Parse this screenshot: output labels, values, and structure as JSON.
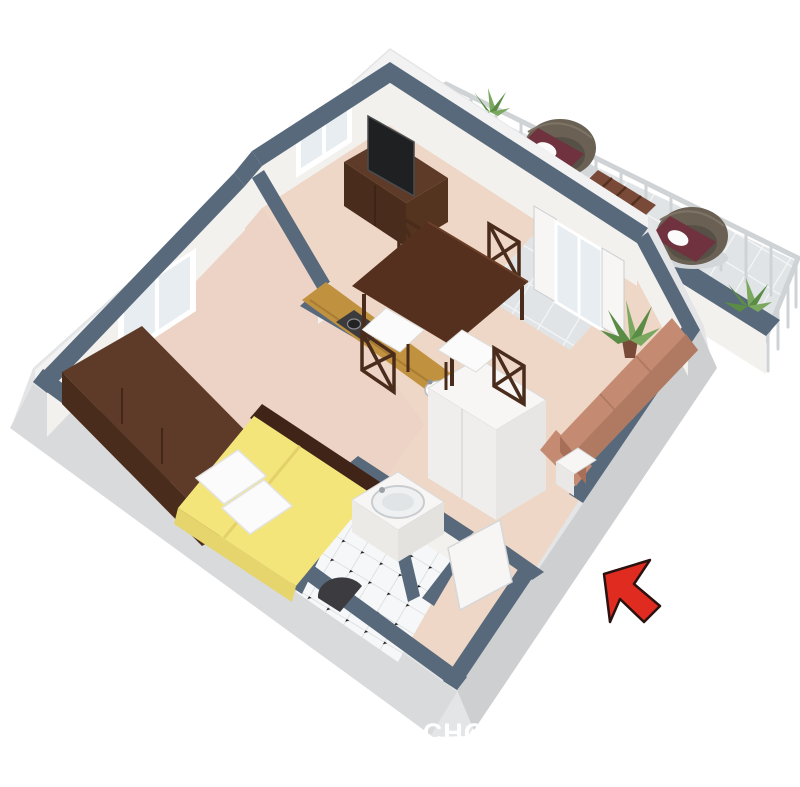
{
  "watermark": {
    "text": "OVANIvCHO",
    "color": "#ffffff"
  },
  "annotation": {
    "arrow_meaning": "entrance-pointer",
    "arrow_color": "#e02b20"
  },
  "scene": {
    "type": "3d-floorplan",
    "rooms": [
      "living-dining-room",
      "kitchen",
      "bedroom",
      "bathroom",
      "hallway-entrance",
      "balcony"
    ],
    "furniture": [
      "double-bed",
      "wardrobe",
      "kitchen-counter",
      "stove",
      "kitchen-sink",
      "dining-table",
      "dining-chairs",
      "tv",
      "tv-stand",
      "sofa",
      "potted-plant",
      "hall-closet",
      "bathroom-vanity",
      "toilet",
      "balcony-armchairs",
      "balcony-table",
      "balcony-railing",
      "balcony-plants",
      "windows",
      "entrance-door",
      "balcony-french-door"
    ]
  },
  "palette": {
    "bg": "#ffffff",
    "wall_top": "#57697b",
    "outer_face": "#e4e5e6",
    "outer_face_sw": "#d9dadb",
    "outer_face_se": "#cdcfd1",
    "outer_strip": "#f2f2f3",
    "inner_face": "#f3f1ee",
    "floor": "#eed7c6",
    "floor_bedroom": "#ecd3c5",
    "tile_balcony": "#e1e4e6",
    "tile_grout": "#f4f6f7",
    "tile_bath": "#f6f7f8",
    "bath_grout": "#d9dcde",
    "counter": "#c0913f",
    "counter_dark": "#a87c33",
    "wood_dark": "#4a2c1c",
    "wood_mid": "#5d3b28",
    "wood_table": "#55301f",
    "bed_yellow": "#f4e57b",
    "bed_yellow_dark": "#e6d46d",
    "headboard": "#3f2417",
    "pillow": "#fbfbfb",
    "sofa": "#c58b72",
    "sofa_dark": "#b07a62",
    "tv": "#1f2022",
    "stove": "#3c3c3e",
    "wicker": "#6a6154",
    "wicker_dark": "#575046",
    "cushion": "#70323f",
    "plant": "#5b8c46",
    "plant_light": "#7aa85e",
    "pot": "#7a4a38",
    "rail": "#cfd3d5",
    "white_obj": "#f7f6f4",
    "glass": "#e7edf0",
    "arrow": "#e02b20",
    "arrow_outline": "#2a1210",
    "watermark": "#ffffff"
  }
}
